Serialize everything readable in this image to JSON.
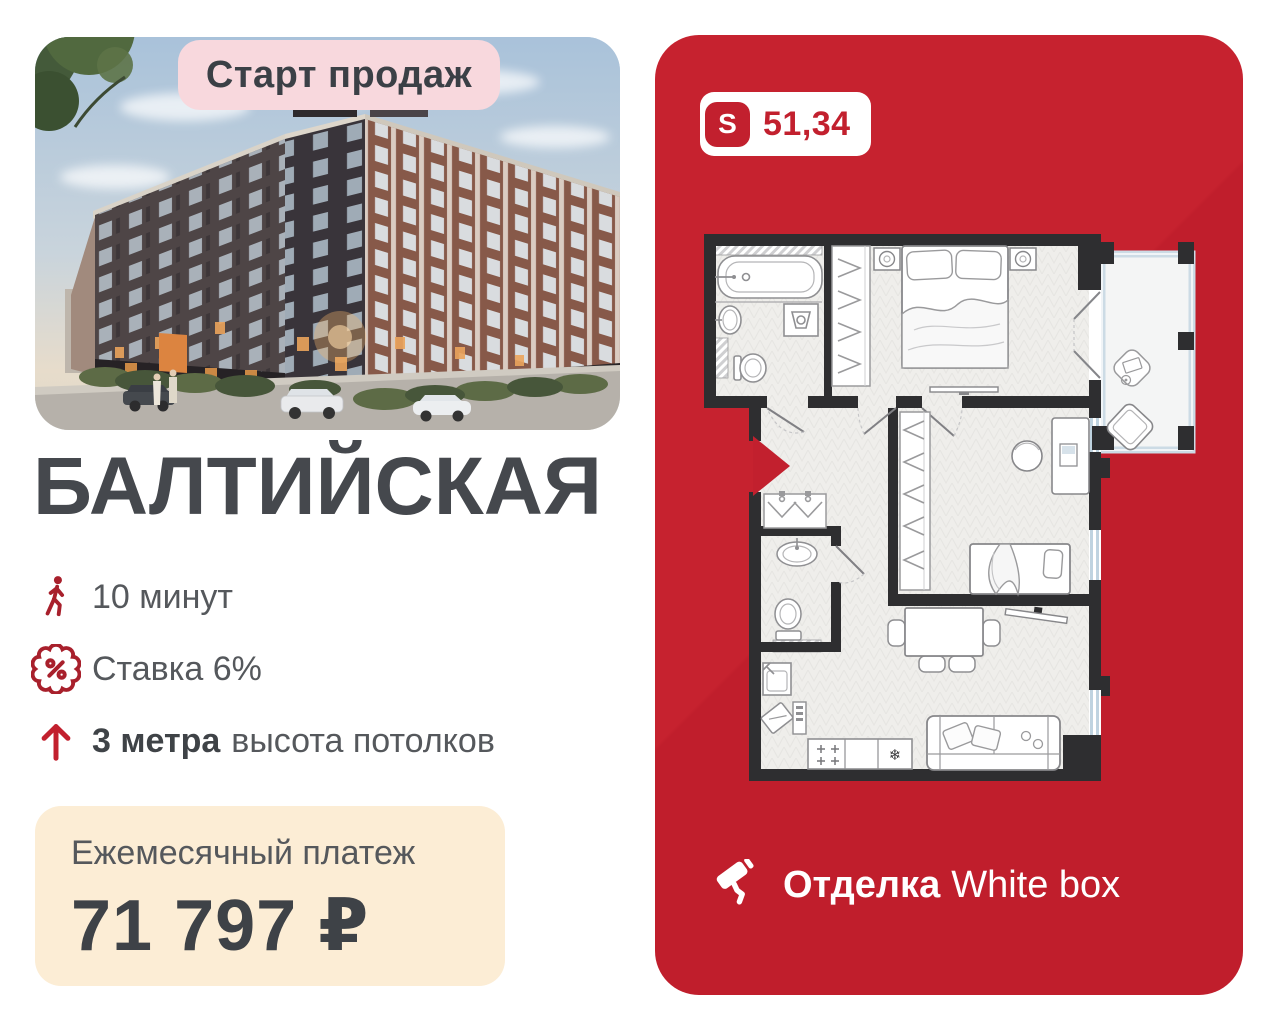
{
  "colors": {
    "brand_red": "#c2202e",
    "badge_pink": "#f8d8dd",
    "payment_cream": "#fcedd5",
    "title_gray": "#45484d",
    "icon_red": "#a8202c"
  },
  "left": {
    "start_badge": "Старт продаж",
    "title": "БАЛТИЙСКАЯ",
    "features": [
      {
        "id": "walk-time",
        "text": "10 минут"
      },
      {
        "id": "mortgage-rate",
        "text": "Ставка 6%"
      },
      {
        "id": "ceiling-height",
        "bold": "3 метра",
        "rest": "высота потолков"
      }
    ],
    "payment": {
      "label": "Ежемесячный платеж",
      "value": "71 797 ₽"
    }
  },
  "right": {
    "area_badge": {
      "letter": "S",
      "value": "51,34"
    },
    "finish": {
      "bold": "Отделка",
      "rest": "White box"
    },
    "plan": {
      "fridge_symbol": "❄"
    }
  }
}
